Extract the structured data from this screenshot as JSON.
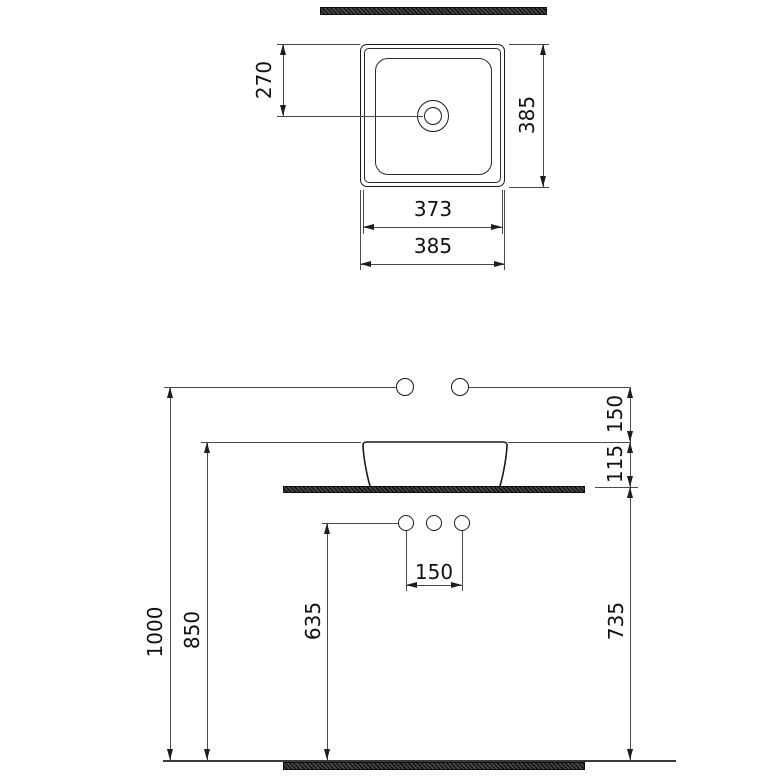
{
  "top_view": {
    "dim_drain_offset": "270",
    "dim_height": "385",
    "dim_inner_width": "373",
    "dim_width": "385"
  },
  "front_view": {
    "dim_ref_to_rim": "150",
    "dim_rim_above_counter": "115",
    "dim_ref_line_height": "1000",
    "dim_rim_height": "850",
    "dim_hole_height": "635",
    "dim_hole_spacing": "150",
    "dim_counter_height": "735"
  },
  "colors": {
    "object_line": "#1a1a1a",
    "dim_line": "#4a4a4a",
    "hatch_fill": "#161616",
    "background": "#ffffff"
  }
}
